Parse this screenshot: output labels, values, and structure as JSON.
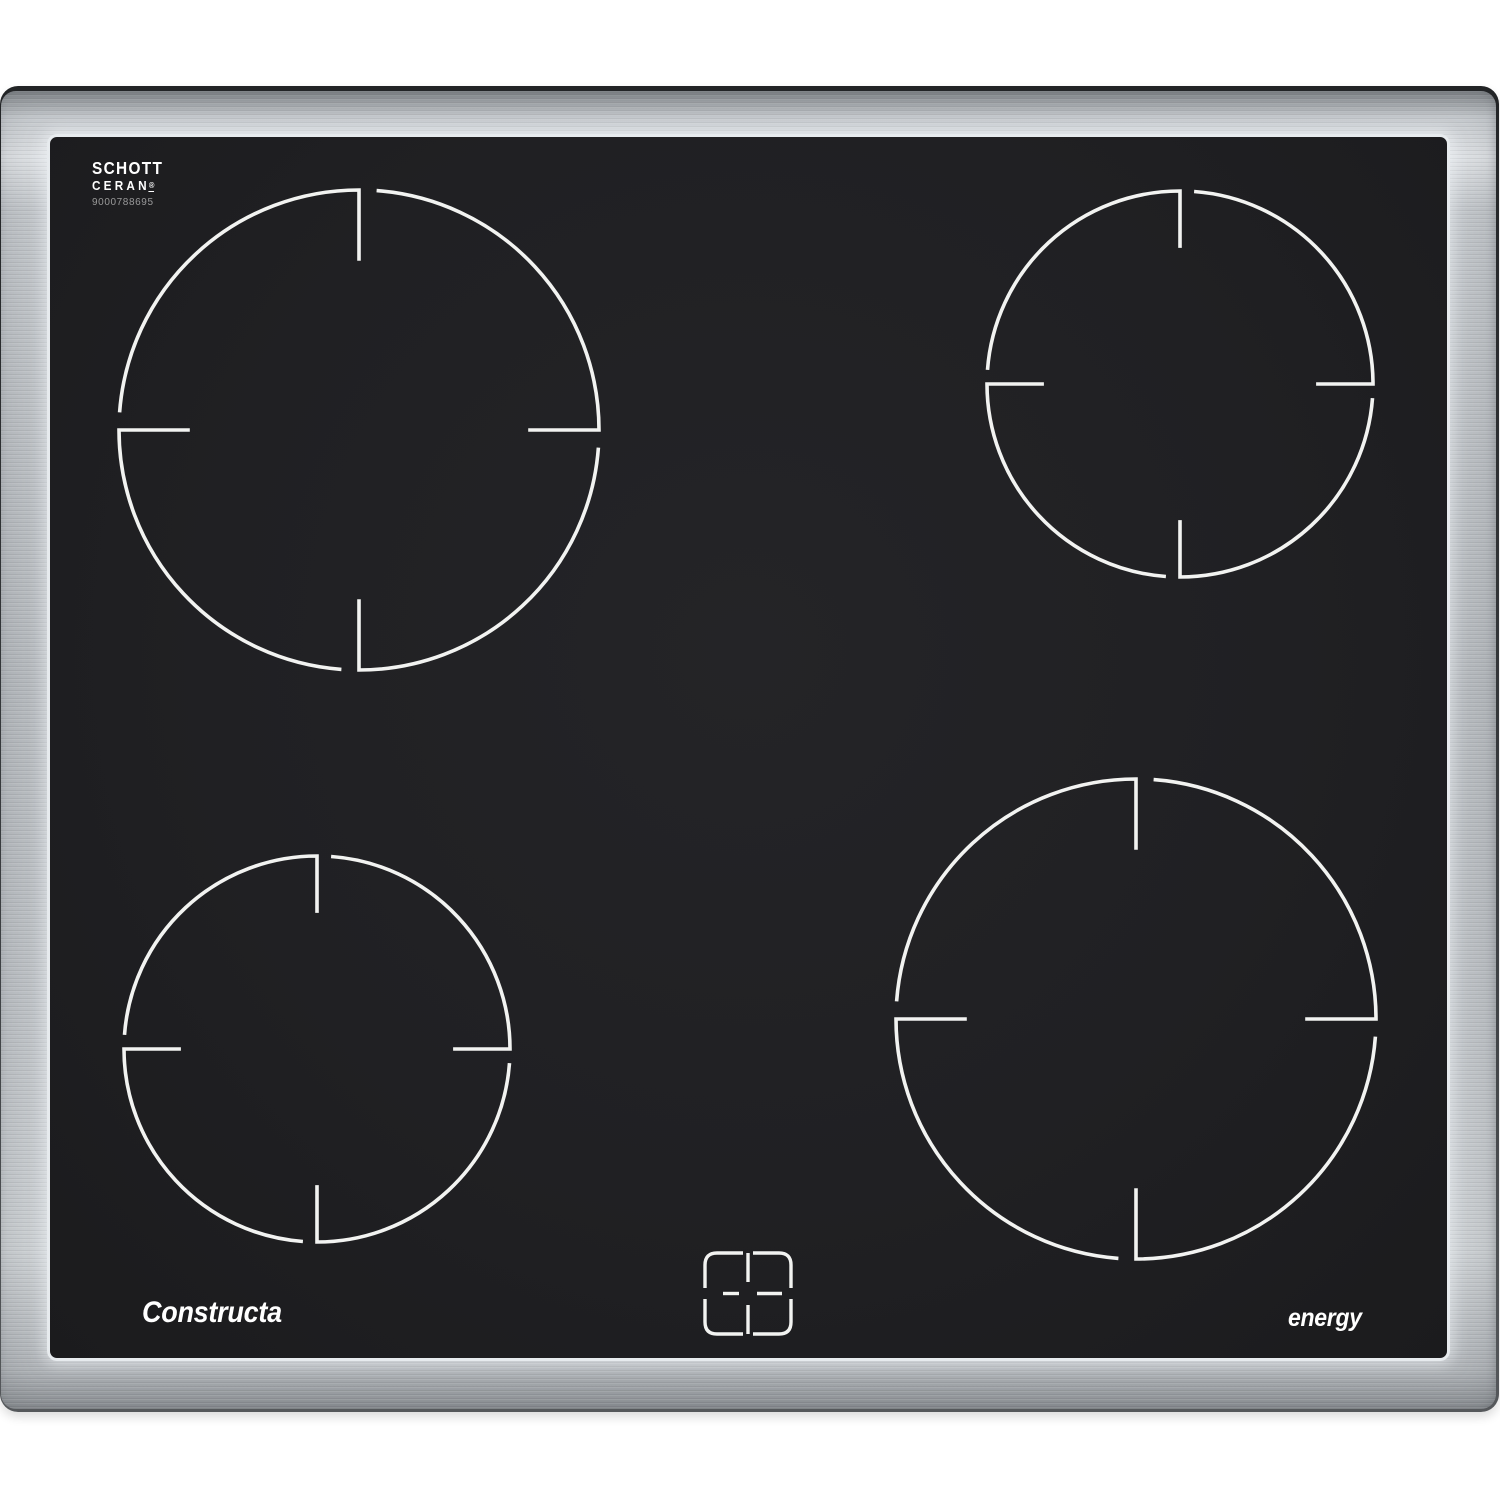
{
  "branding": {
    "glass_brand": {
      "line1": "SCHOTT",
      "line2": "CERAN",
      "registered_mark": "®"
    },
    "serial_number": "9000788695",
    "manufacturer": "Constructa",
    "energy_label": "energy"
  },
  "colors": {
    "background": "#ffffff",
    "steel_light": "#dfe2e5",
    "steel_mid": "#b7bbbf",
    "steel_dark": "#84888c",
    "edge_dark": "#2d2f31",
    "glass": "#1b1b1d",
    "ring": "#f2f3f1",
    "serial_text": "#9a9a9a"
  },
  "cooktop": {
    "zones": [
      {
        "name": "rear-left",
        "size": "large",
        "cx": 359,
        "cy": 430,
        "r": 240
      },
      {
        "name": "rear-right",
        "size": "standard",
        "cx": 1180,
        "cy": 384,
        "r": 193
      },
      {
        "name": "front-left",
        "size": "standard",
        "cx": 317,
        "cy": 1049,
        "r": 193
      },
      {
        "name": "front-right",
        "size": "large",
        "cx": 1136,
        "cy": 1019,
        "r": 240
      }
    ],
    "ring_style": {
      "stroke_width": 3.6,
      "gap_degrees": 4.2,
      "tick_ratio": 0.295
    },
    "four_zone_icon": {
      "cx": 748,
      "cy": 1294,
      "width": 91,
      "height": 87
    }
  }
}
